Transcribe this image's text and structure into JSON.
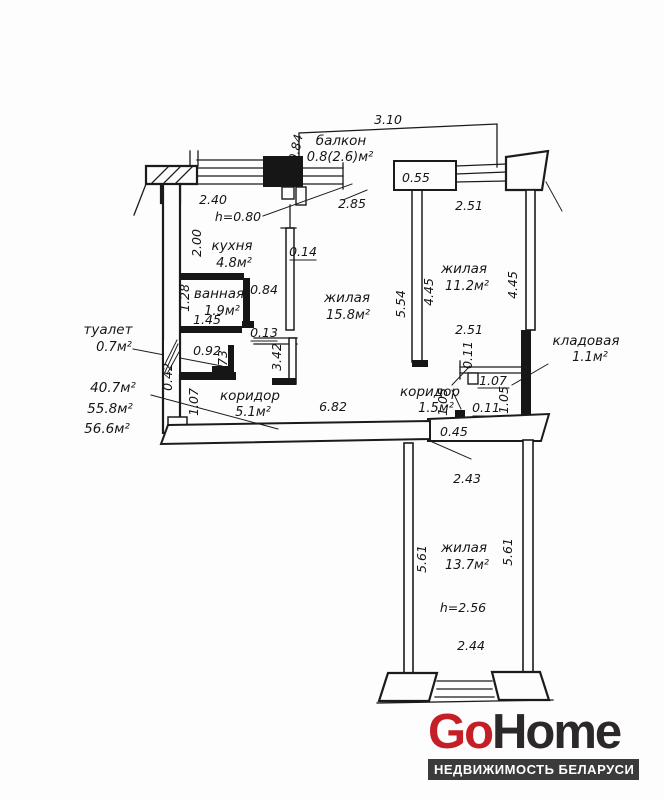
{
  "plan": {
    "totals": [
      "40.7м²",
      "55.8м²",
      "56.6м²"
    ],
    "rooms": {
      "balcony": {
        "name": "балкон",
        "area": "0.8(2.6)м²"
      },
      "kitchen": {
        "name": "кухня",
        "area": "4.8м²"
      },
      "bathroom": {
        "name": "ванная",
        "area": "1.9м²"
      },
      "toilet": {
        "name": "туалет",
        "area": "0.7м²"
      },
      "living1": {
        "name": "жилая",
        "area": "15.8м²"
      },
      "living2": {
        "name": "жилая",
        "area": "11.2м²"
      },
      "living3": {
        "name": "жилая",
        "area": "13.7м²"
      },
      "corridor": {
        "name": "коридор",
        "area": "5.1м²"
      },
      "corridor2": {
        "name": "коридор",
        "area": "1.5м²"
      },
      "storage": {
        "name": "кладовая",
        "area": "1.1м²"
      }
    },
    "dims": {
      "balcony_width": "3.10",
      "balcony_depth": "0.84",
      "window_right": "0.55",
      "living1_top": "2.85",
      "kitchen_top": "2.40",
      "kitchen_sill": "h=0.80",
      "kitchen_left": "2.00",
      "wall_thick": "0.14",
      "kitchen_door": "0.84",
      "bath_left": "1.28",
      "bath_bottom": "1.45",
      "notch": "0.13",
      "toilet_width": "0.92",
      "toilet_depth": "0.73",
      "wall_left": "0.42",
      "living1_left": "3.42",
      "living1_right": "5.54",
      "living2_left": "4.45",
      "living2_right": "4.45",
      "living2_top": "2.51",
      "living2_bottom": "2.51",
      "storage_wall_top": "0.11",
      "storage_top": "1.07",
      "storage_left": "1.05",
      "storage_right": "1.05",
      "storage_wall_bottom": "0.11",
      "entry_door": "0.45",
      "corridor_left": "1.07",
      "corridor_width": "6.82",
      "living3_top": "2.43",
      "living3_left": "5.61",
      "living3_right": "5.61",
      "ceiling_height": "h=2.56",
      "living3_bottom": "2.44"
    }
  },
  "logo": {
    "go": "Go",
    "home": "Home",
    "tagline": "НЕДВИЖИМОСТЬ БЕЛАРУСИ",
    "go_color": "#c41e26",
    "home_color": "#2c282a",
    "tagline_bg": "#3b3b3b"
  }
}
